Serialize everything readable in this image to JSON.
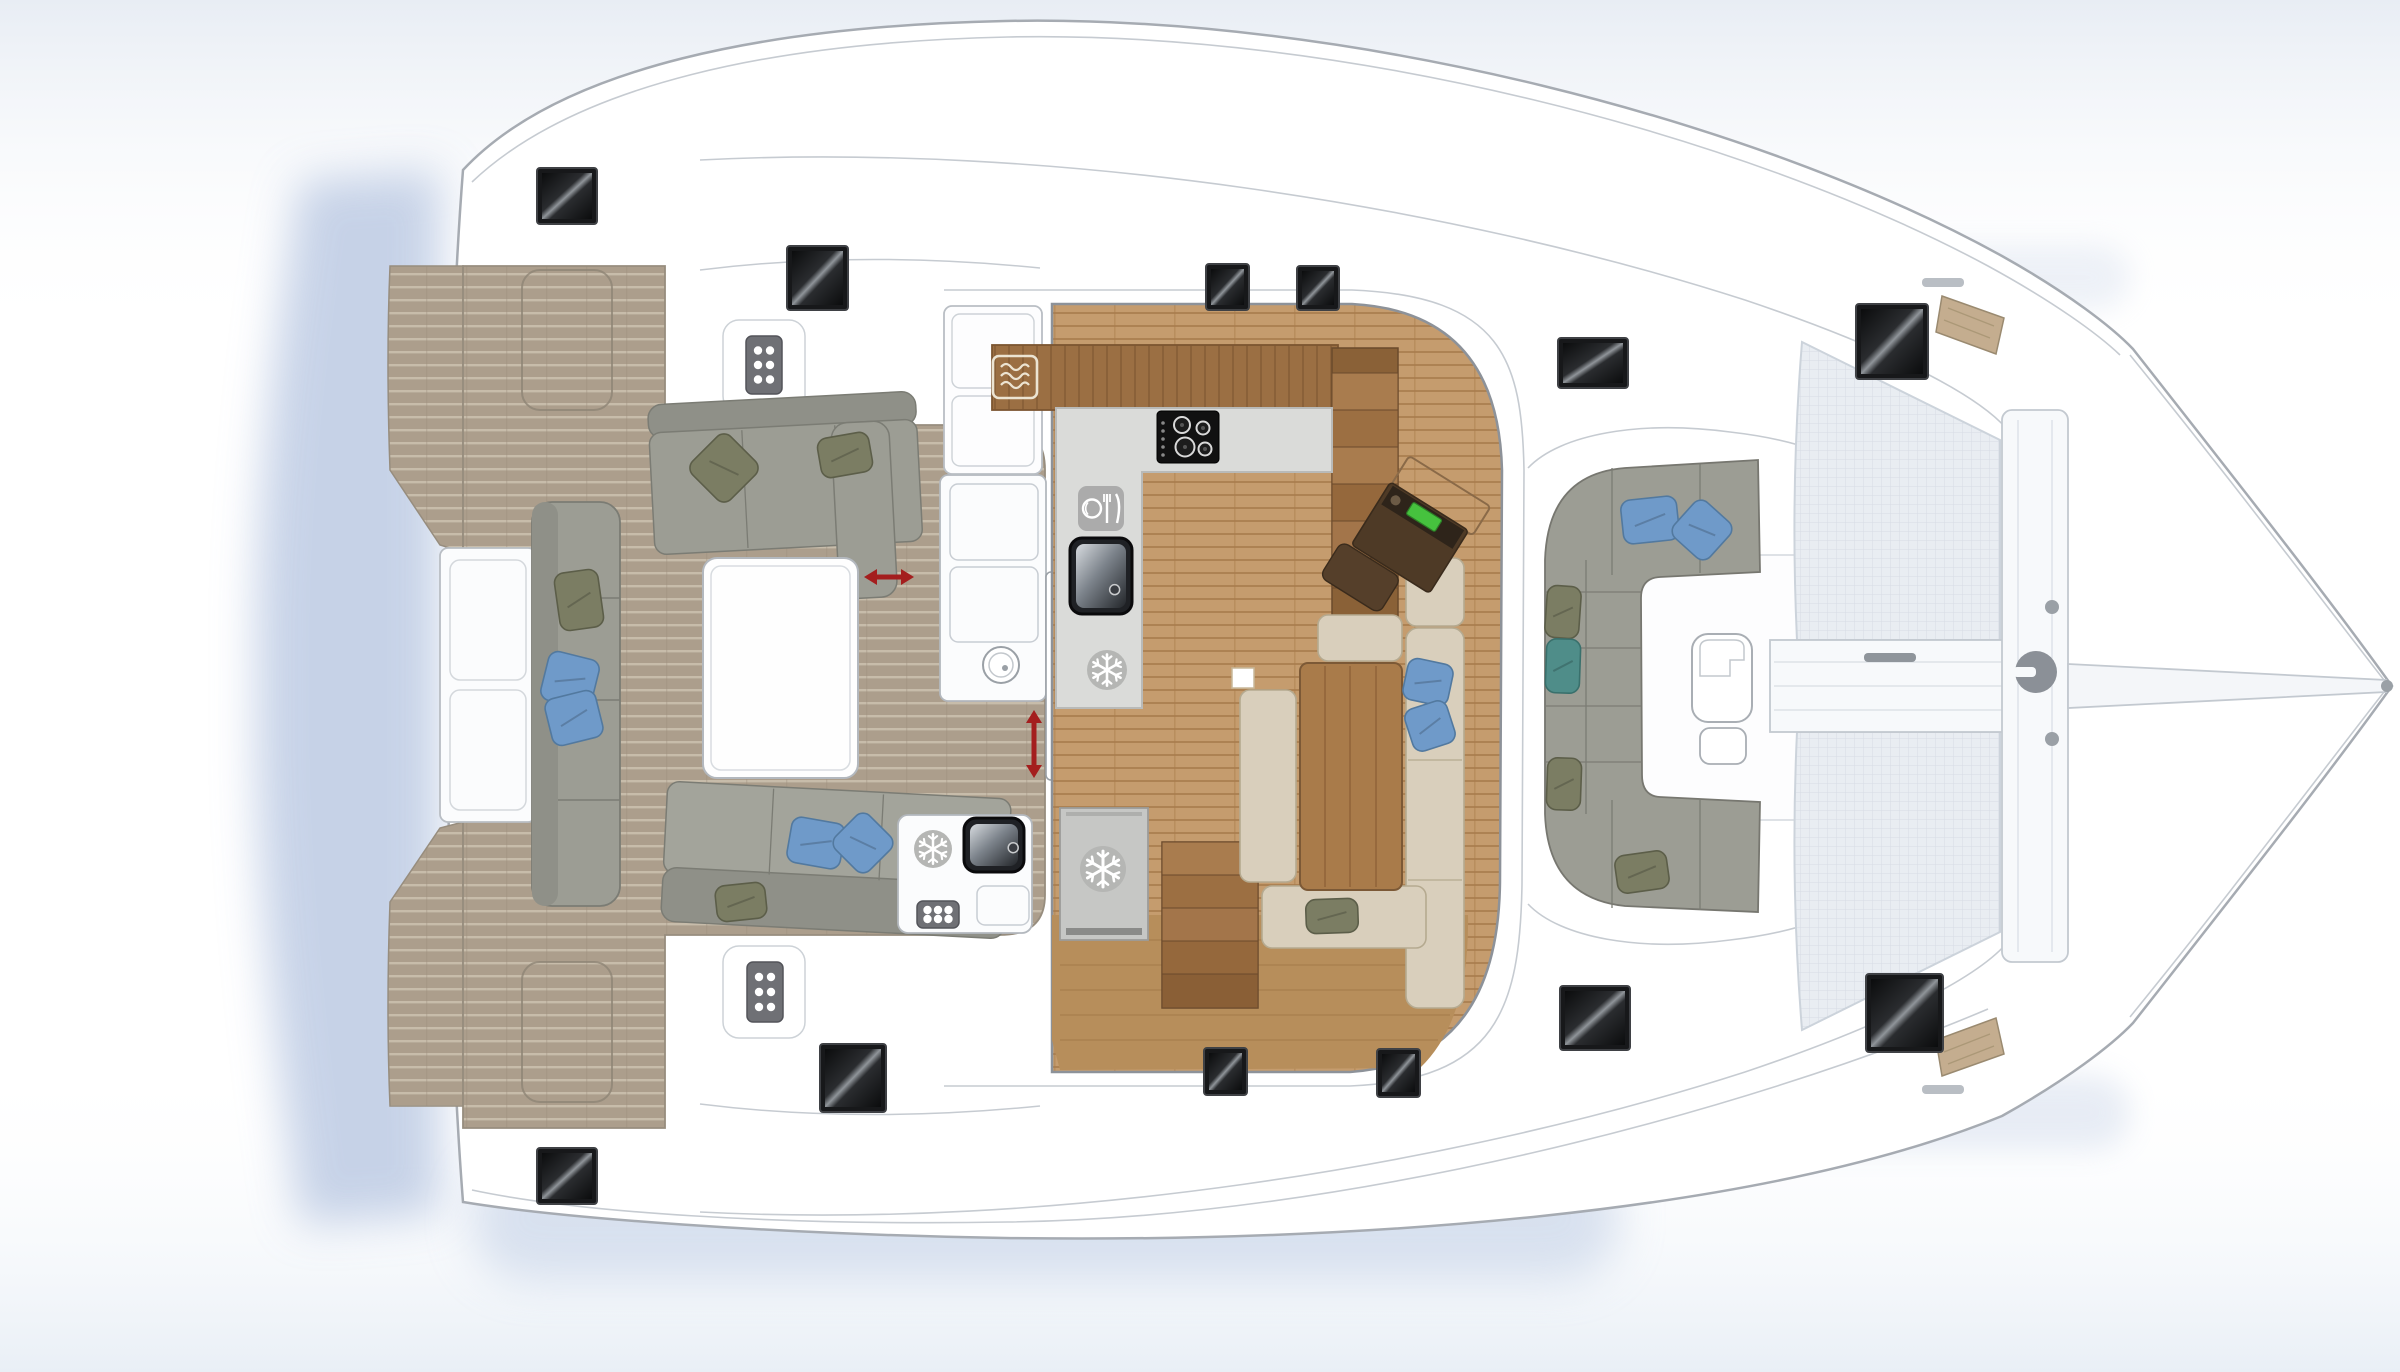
{
  "plan": {
    "subject": "catamaran-deck-plan",
    "view": "overhead"
  },
  "colors": {
    "hull_stroke": "#a6abb2",
    "light_stroke": "#c6cbd1",
    "teak": "#ac9e8c",
    "teak_stripe": "#c7bcaa",
    "wood_floor": "#c59c6e",
    "wood_stripe": "#a87c4c",
    "wood_cabinet": "#9b6f43",
    "counter_gray": "#dadbd9",
    "sofa_gray": "#9c9d94",
    "sofa_gray_dark": "#8f9088",
    "sofa_beige": "#d9cfbc",
    "pillow_blue": "#6f9ac9",
    "pillow_olive": "#7b7d63",
    "pillow_teal": "#4f8d89",
    "hatch_dark": "#17181a",
    "arrow_red": "#a41e1e",
    "trampoline": "#e9edf2",
    "icon_gray": "#b5b6b4",
    "nav_brown": "#4e3a26",
    "screen_green": "#46c23e",
    "shadow_blue": "#b9c8e2"
  },
  "hatches": [
    {
      "x": 537,
      "y": 168,
      "w": 60,
      "h": 56
    },
    {
      "x": 787,
      "y": 246,
      "w": 61,
      "h": 64
    },
    {
      "x": 1206,
      "y": 264,
      "w": 43,
      "h": 46
    },
    {
      "x": 1297,
      "y": 266,
      "w": 42,
      "h": 44
    },
    {
      "x": 1558,
      "y": 338,
      "w": 70,
      "h": 50
    },
    {
      "x": 1856,
      "y": 304,
      "w": 72,
      "h": 75
    },
    {
      "x": 537,
      "y": 1148,
      "w": 60,
      "h": 56
    },
    {
      "x": 820,
      "y": 1044,
      "w": 66,
      "h": 68
    },
    {
      "x": 1204,
      "y": 1048,
      "w": 43,
      "h": 47
    },
    {
      "x": 1377,
      "y": 1049,
      "w": 43,
      "h": 48
    },
    {
      "x": 1560,
      "y": 986,
      "w": 70,
      "h": 64
    },
    {
      "x": 1866,
      "y": 974,
      "w": 77,
      "h": 78
    }
  ],
  "vent_grids": [
    {
      "x": 746,
      "y": 336,
      "w": 36,
      "h": 58,
      "cols": 2,
      "rows": 3
    },
    {
      "x": 747,
      "y": 962,
      "w": 36,
      "h": 60,
      "cols": 2,
      "rows": 3
    },
    {
      "x": 917,
      "y": 901,
      "w": 42,
      "h": 27,
      "cols": 3,
      "rows": 2
    }
  ],
  "pillows": [
    {
      "cx": 579,
      "cy": 600,
      "w": 44,
      "h": 58,
      "rot": -8,
      "color": "olive"
    },
    {
      "cx": 570,
      "cy": 680,
      "w": 52,
      "h": 50,
      "rot": 14,
      "color": "blue"
    },
    {
      "cx": 574,
      "cy": 718,
      "w": 52,
      "h": 48,
      "rot": -14,
      "color": "blue"
    },
    {
      "cx": 724,
      "cy": 468,
      "w": 54,
      "h": 54,
      "rot": 45,
      "color": "olive"
    },
    {
      "cx": 845,
      "cy": 455,
      "w": 52,
      "h": 40,
      "rot": -10,
      "color": "olive"
    },
    {
      "cx": 816,
      "cy": 843,
      "w": 54,
      "h": 46,
      "rot": 10,
      "color": "blue"
    },
    {
      "cx": 863,
      "cy": 843,
      "w": 48,
      "h": 48,
      "rot": 45,
      "color": "blue"
    },
    {
      "cx": 741,
      "cy": 902,
      "w": 50,
      "h": 36,
      "rot": -6,
      "color": "olive"
    },
    {
      "cx": 1428,
      "cy": 682,
      "w": 46,
      "h": 42,
      "rot": 12,
      "color": "blue"
    },
    {
      "cx": 1430,
      "cy": 726,
      "w": 44,
      "h": 44,
      "rot": -18,
      "color": "blue"
    },
    {
      "cx": 1332,
      "cy": 916,
      "w": 52,
      "h": 34,
      "rot": -2,
      "color": "olive"
    },
    {
      "cx": 1650,
      "cy": 520,
      "w": 56,
      "h": 44,
      "rot": -6,
      "color": "blue"
    },
    {
      "cx": 1702,
      "cy": 530,
      "w": 48,
      "h": 48,
      "rot": 42,
      "color": "blue"
    },
    {
      "cx": 1563,
      "cy": 612,
      "w": 34,
      "h": 52,
      "rot": 4,
      "color": "olive"
    },
    {
      "cx": 1563,
      "cy": 666,
      "w": 34,
      "h": 54,
      "rot": 2,
      "color": "teal"
    },
    {
      "cx": 1564,
      "cy": 784,
      "w": 34,
      "h": 52,
      "rot": 2,
      "color": "olive"
    },
    {
      "cx": 1642,
      "cy": 872,
      "w": 52,
      "h": 38,
      "rot": -8,
      "color": "olive"
    }
  ],
  "arrows": [
    {
      "x1": 864,
      "y1": 577,
      "x2": 914,
      "y2": 577
    },
    {
      "x1": 1034,
      "y1": 710,
      "x2": 1034,
      "y2": 778
    }
  ],
  "appliances": [
    {
      "type": "microwave",
      "x": 993,
      "y": 356,
      "w": 44,
      "h": 42
    },
    {
      "type": "dishwasher",
      "x": 1078,
      "y": 486,
      "w": 46,
      "h": 45
    },
    {
      "type": "cooktop",
      "x": 1157,
      "y": 411,
      "w": 62,
      "h": 52
    },
    {
      "type": "sink",
      "x": 1070,
      "y": 538,
      "w": 62,
      "h": 76,
      "fx": 0.72,
      "fy": 0.68
    },
    {
      "type": "sink",
      "x": 964,
      "y": 818,
      "w": 60,
      "h": 54,
      "fx": 0.82,
      "fy": 0.55
    },
    {
      "type": "sink-round",
      "cx": 1001,
      "cy": 665,
      "r": 18
    },
    {
      "type": "snowflake",
      "cx": 1107,
      "cy": 670,
      "r": 20
    },
    {
      "type": "snowflake",
      "cx": 1103,
      "cy": 869,
      "r": 23
    },
    {
      "type": "snowflake",
      "cx": 933,
      "cy": 849,
      "r": 19
    },
    {
      "type": "windlass",
      "cx": 2036,
      "cy": 672,
      "r": 21
    }
  ]
}
